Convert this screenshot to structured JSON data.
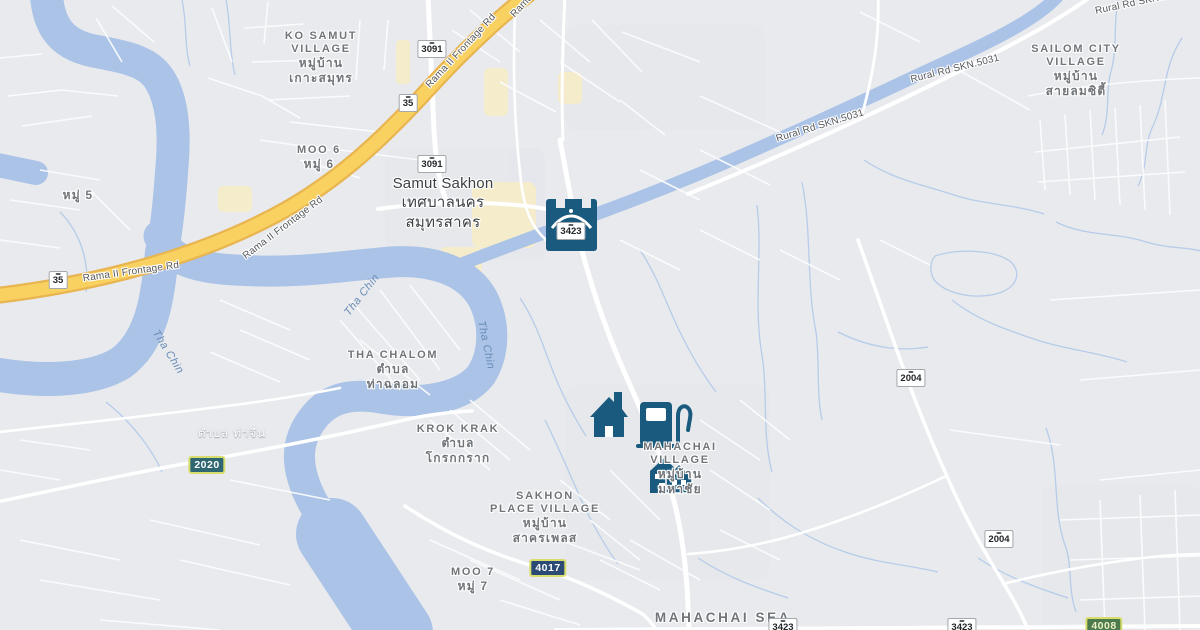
{
  "map_title": "Samut Sakhon area map",
  "colors": {
    "land": "#e8eaee",
    "water": "#aac3e7",
    "canal": "#b6cce9",
    "road_major": "#ffffff",
    "road_minor": "#fbfcfd",
    "highway_fill": "#f9d160",
    "highway_casing": "#e8b551",
    "commercial": "#f4eccb",
    "urban": "#e2e4e9",
    "icon": "#1a5a7e",
    "label_locality": "#70757a",
    "label_city": "#3c4043",
    "label_road": "#56585c",
    "label_water": "#6a8cb5",
    "label_white": "#ffffff",
    "shield_white_border": "#a3a8ad",
    "shield_white_text": "#232629",
    "shield_border_yellow": "#d9dd6d",
    "shield_teal": "#2e6672",
    "shield_navy": "#2c4b74",
    "shield_green": "#4e7b4b"
  },
  "localities": [
    {
      "id": "ko-samut-village",
      "type": "village",
      "x": 321,
      "y": 30,
      "lines": [
        "KO SAMUT",
        "VILLAGE",
        "หมู่บ้าน",
        "เกาะสมุทร"
      ]
    },
    {
      "id": "moo-6",
      "type": "village",
      "x": 319,
      "y": 144,
      "lines": [
        "MOO 6",
        "หมู่ 6"
      ]
    },
    {
      "id": "samut-sakhon",
      "type": "city",
      "x": 443,
      "y": 174,
      "lines": [
        "Samut Sakhon",
        "เทศบาลนคร",
        "สมุทรสาคร"
      ]
    },
    {
      "id": "sailom-city-village",
      "type": "village",
      "x": 1076,
      "y": 43,
      "lines": [
        "SAILOM CITY",
        "VILLAGE",
        "หมู่บ้าน",
        "สายลมซิตี้"
      ]
    },
    {
      "id": "moo-5",
      "type": "village",
      "x": 78,
      "y": 188,
      "lines": [
        "หมู่ 5"
      ]
    },
    {
      "id": "tha-chalom",
      "type": "village",
      "x": 393,
      "y": 349,
      "lines": [
        "THA CHALOM",
        "ตำบล",
        "ท่าฉลอม"
      ]
    },
    {
      "id": "krok-krak",
      "type": "village",
      "x": 458,
      "y": 423,
      "lines": [
        "KROK KRAK",
        "ตำบล",
        "โกรกกราก"
      ]
    },
    {
      "id": "mahachai-village",
      "type": "village",
      "x": 680,
      "y": 441,
      "lines": [
        "MAHACHAI",
        "VILLAGE",
        "หมู่บ้าน",
        "มหาชัย"
      ]
    },
    {
      "id": "sakhon-place-village",
      "type": "village",
      "x": 545,
      "y": 490,
      "lines": [
        "SAKHON",
        "PLACE VILLAGE",
        "หมู่บ้าน",
        "สาครเพลส"
      ]
    },
    {
      "id": "moo-7",
      "type": "village",
      "x": 473,
      "y": 566,
      "lines": [
        "MOO 7",
        "หมู่ 7"
      ]
    },
    {
      "id": "mahachai-sea",
      "type": "sea",
      "x": 723,
      "y": 611,
      "lines": [
        "MAHACHAI SEA"
      ]
    },
    {
      "id": "tambon-tha-chin",
      "type": "white",
      "x": 232,
      "y": 427,
      "lines": [
        "ตำบล ท่าจีน"
      ]
    }
  ],
  "road_labels": [
    {
      "text": "Rama II Frontage Rd",
      "x": 131,
      "y": 272,
      "rot": -8
    },
    {
      "text": "Rama II Frontage Rd",
      "x": 283,
      "y": 228,
      "rot": -37
    },
    {
      "text": "Rama II Frontage Rd",
      "x": 461,
      "y": 51,
      "rot": -47
    },
    {
      "text": "Rama",
      "x": 522,
      "y": 6,
      "rot": -48
    },
    {
      "text": "Rural Rd SKN.5031",
      "x": 955,
      "y": 69,
      "rot": -14
    },
    {
      "text": "Rural Rd SKN.5031",
      "x": 820,
      "y": 126,
      "rot": -17
    },
    {
      "text": "Rural Rd SKN.5031",
      "x": 1140,
      "y": 2,
      "rot": -12
    }
  ],
  "river_labels": [
    {
      "text": "Tha Chin",
      "x": 168,
      "y": 352,
      "rot": 58
    },
    {
      "text": "Tha Chin",
      "x": 362,
      "y": 295,
      "rot": -52
    },
    {
      "text": "Tha Chin",
      "x": 486,
      "y": 345,
      "rot": 78
    }
  ],
  "shields": [
    {
      "text": "3091",
      "style": "white",
      "x": 432,
      "y": 49
    },
    {
      "text": "3091",
      "style": "white",
      "x": 432,
      "y": 164
    },
    {
      "text": "35",
      "style": "white",
      "x": 58,
      "y": 280
    },
    {
      "text": "35",
      "style": "white",
      "x": 408,
      "y": 103
    },
    {
      "text": "3423",
      "style": "white",
      "x": 571,
      "y": 231
    },
    {
      "text": "3423",
      "style": "white",
      "x": 783,
      "y": 627
    },
    {
      "text": "3423",
      "style": "white",
      "x": 962,
      "y": 627
    },
    {
      "text": "2004",
      "style": "white",
      "x": 911,
      "y": 378
    },
    {
      "text": "2004",
      "style": "white",
      "x": 999,
      "y": 539
    },
    {
      "text": "2020",
      "style": "teal",
      "x": 207,
      "y": 465
    },
    {
      "text": "4017",
      "style": "navy",
      "x": 548,
      "y": 568
    },
    {
      "text": "4008",
      "style": "green",
      "x": 1104,
      "y": 626
    }
  ],
  "poi_icons": [
    {
      "icon": "bridge-icon",
      "x": 571,
      "y": 225
    },
    {
      "icon": "house-icon",
      "x": 609,
      "y": 415
    },
    {
      "icon": "gas-station-icon",
      "x": 658,
      "y": 424
    },
    {
      "icon": "residential-icon",
      "x": 671,
      "y": 476
    }
  ]
}
